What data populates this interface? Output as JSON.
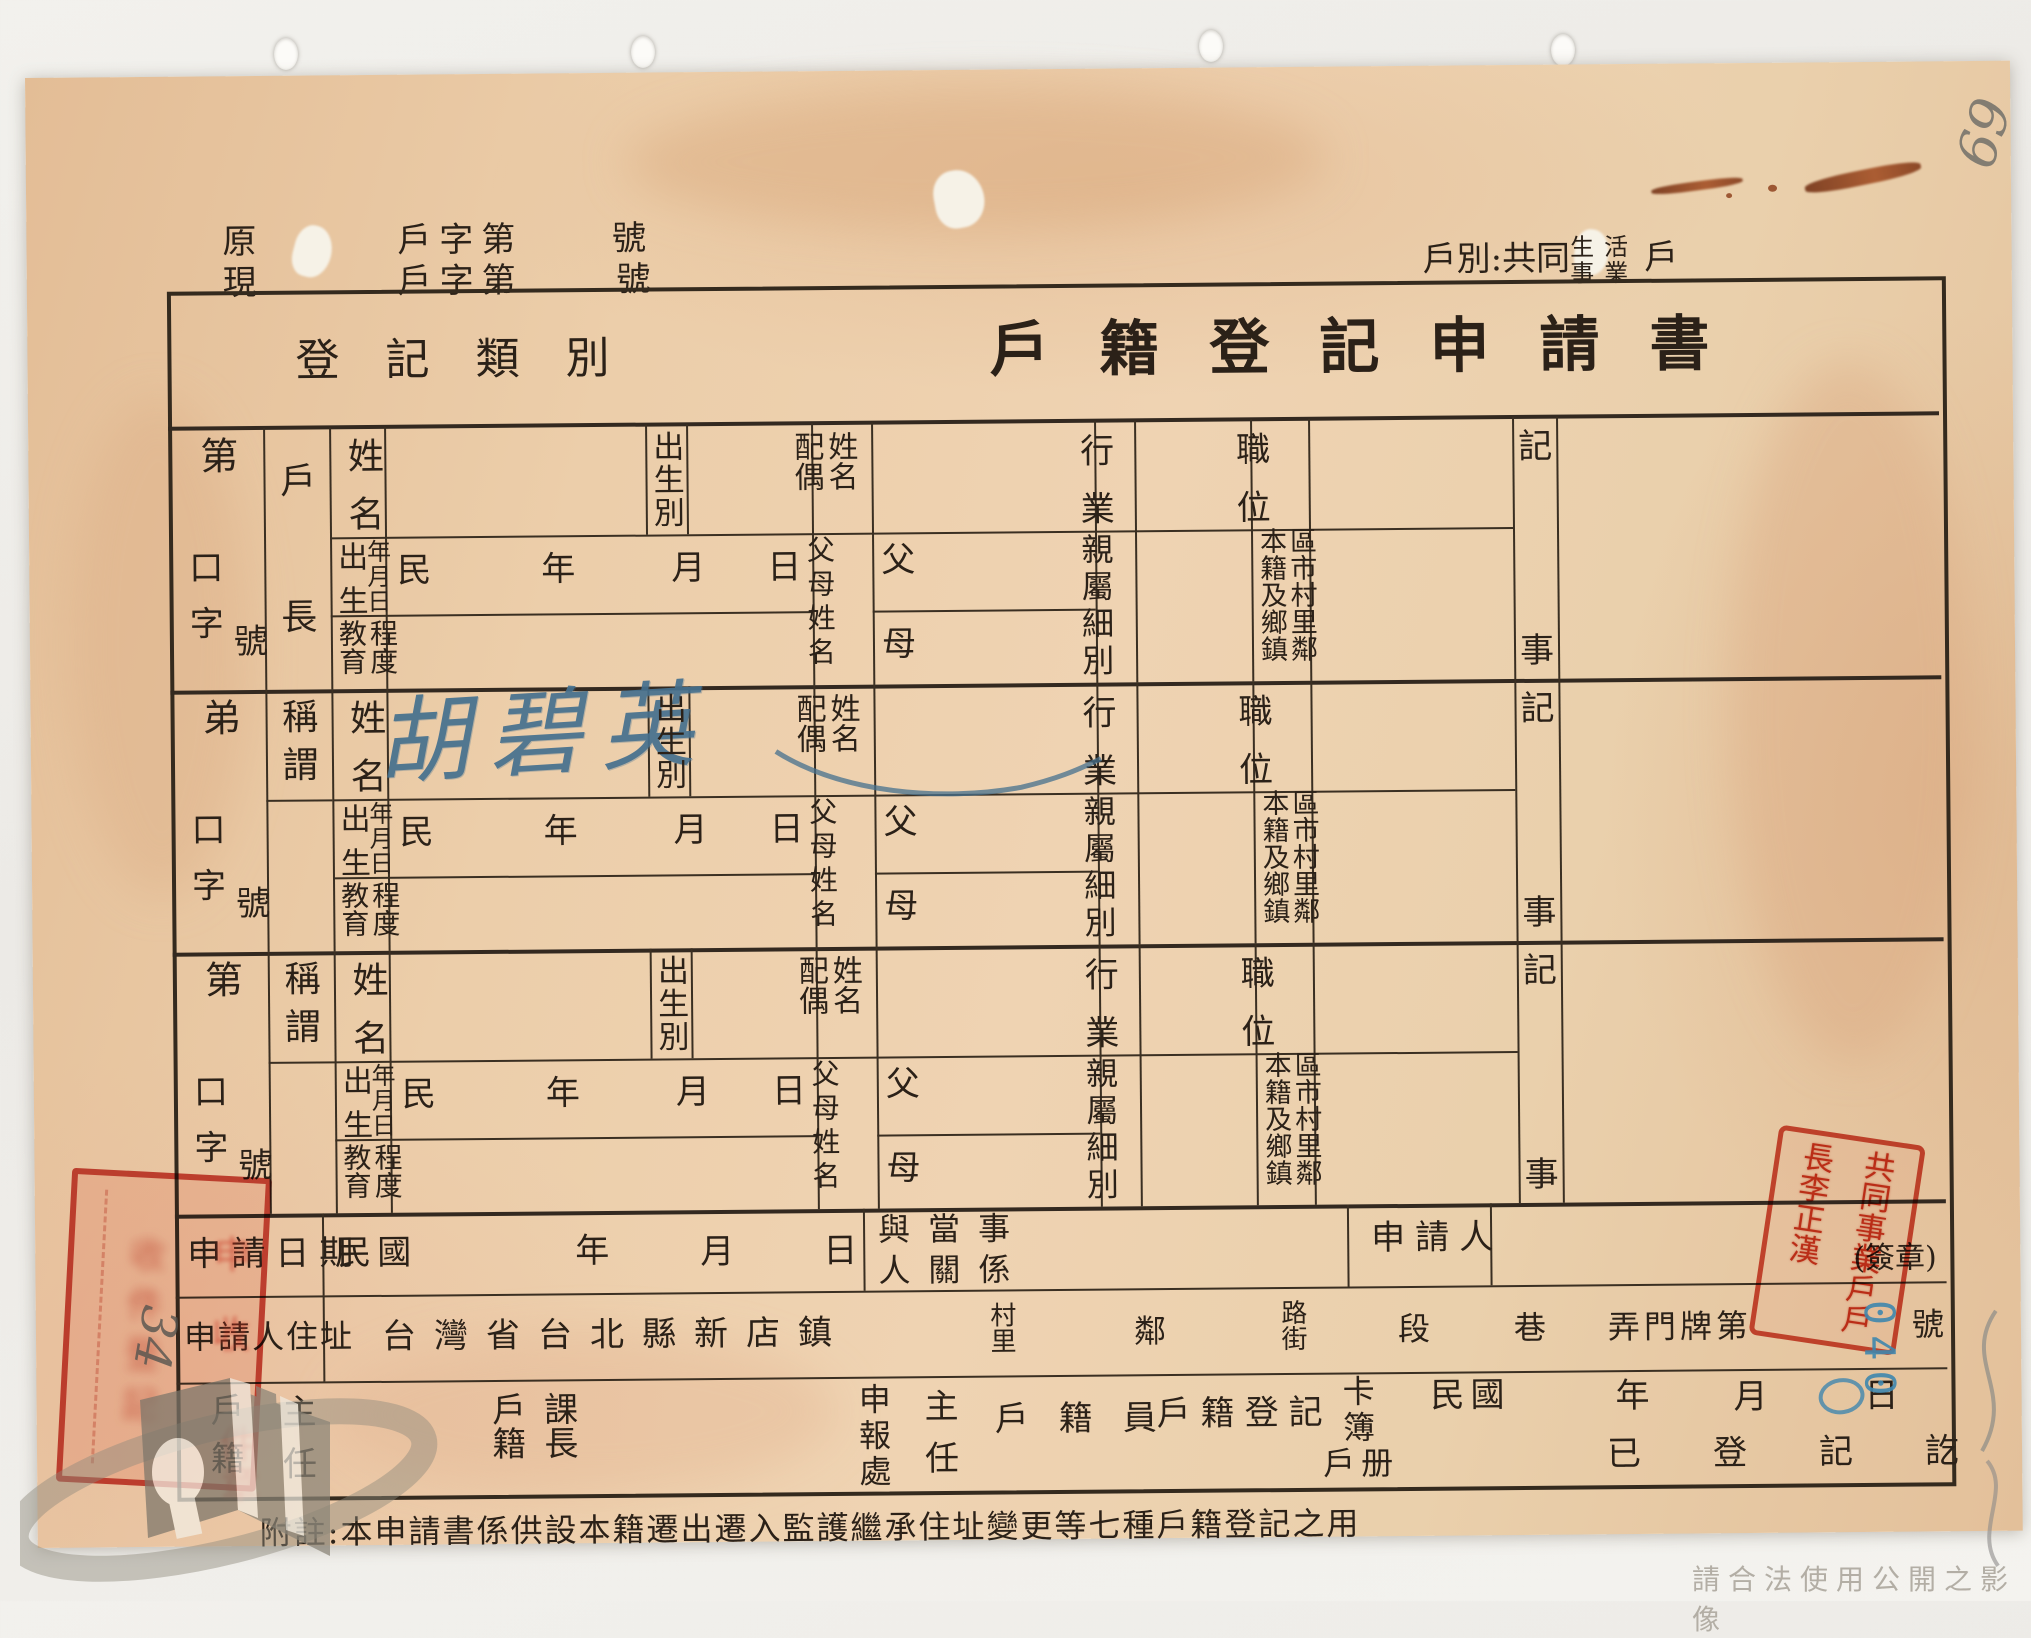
{
  "header": {
    "doc_rows": [
      {
        "prefix": "原",
        "label": "戶字第",
        "suffix": "號"
      },
      {
        "prefix": "現",
        "label": "戶字第",
        "suffix": "號"
      }
    ],
    "household": {
      "lead": "戶別:共同",
      "stack_top": "生活",
      "stack_bottom": "事業",
      "tail": "戶"
    },
    "pencil_number": "69"
  },
  "title": {
    "category": "登記類別",
    "main": "戶籍登記申請書"
  },
  "fields": {
    "name": "姓名",
    "birth_order": "出生別",
    "spouse": "配偶姓名",
    "birth_left": "出生",
    "birth_right": "年月日",
    "era": "民",
    "year": "年",
    "month": "月",
    "day": "日",
    "parents": "父母姓名",
    "father": "父",
    "mother": "母",
    "industry": "行業",
    "position": "職位",
    "kinship": "親屬細別",
    "origin": "本籍及鄉鎮區市村里鄰",
    "education": "教育程度",
    "record_top": "記",
    "record_bottom": "事"
  },
  "sections": [
    {
      "seq": "第",
      "unit": "口",
      "unit2": "字",
      "no": "號",
      "role": "戶長",
      "name_value": "",
      "role_mode": "spread"
    },
    {
      "seq": "弟",
      "unit": "口",
      "unit2": "字",
      "no": "號",
      "role": "稱謂",
      "name_value": "胡碧英",
      "role_mode": "top"
    },
    {
      "seq": "第",
      "unit": "口",
      "unit2": "字",
      "no": "號",
      "role": "稱謂",
      "name_value": "",
      "role_mode": "top"
    }
  ],
  "apply_row": {
    "label": "申請日期",
    "era": "民國",
    "year": "年",
    "month": "月",
    "day": "日",
    "relation_line1": "與當事",
    "relation_line2": "人關係",
    "applicant": "申請人",
    "seal": "(簽章)"
  },
  "address_row": {
    "label": "申請人住址",
    "printed_region": "台灣省台北縣新店鎮",
    "village": "村里",
    "neighbor": "鄰",
    "road": "路街",
    "section": "段",
    "lane": "巷",
    "gate": "弄門牌第",
    "number_suffix": "號",
    "blue_number": "040"
  },
  "officials_row": {
    "registry": "戶籍",
    "chief": "主任",
    "registry_section_chief": "戶籍課長",
    "report_office": "申報處",
    "office_chief": "主任",
    "clerk": "戶籍員",
    "registration": "戶籍登記",
    "card": "卡簿",
    "book": "戶册",
    "era": "民國",
    "year": "年",
    "month": "月",
    "day": "日",
    "registered": "已登記訖"
  },
  "footnote": "附註:本申請書係供設本籍遷出遷入監護繼承住址變更等七種戶籍登記之用",
  "stamps": {
    "household_head_seal": "共同事業戶戶長李正漢",
    "receipt_marks": [
      "申",
      "收",
      "件",
      "章"
    ],
    "faint_inner": "收件登記",
    "pencil_side": "34"
  },
  "watermark": {
    "usage_note": "請合法使用公開之影像"
  }
}
